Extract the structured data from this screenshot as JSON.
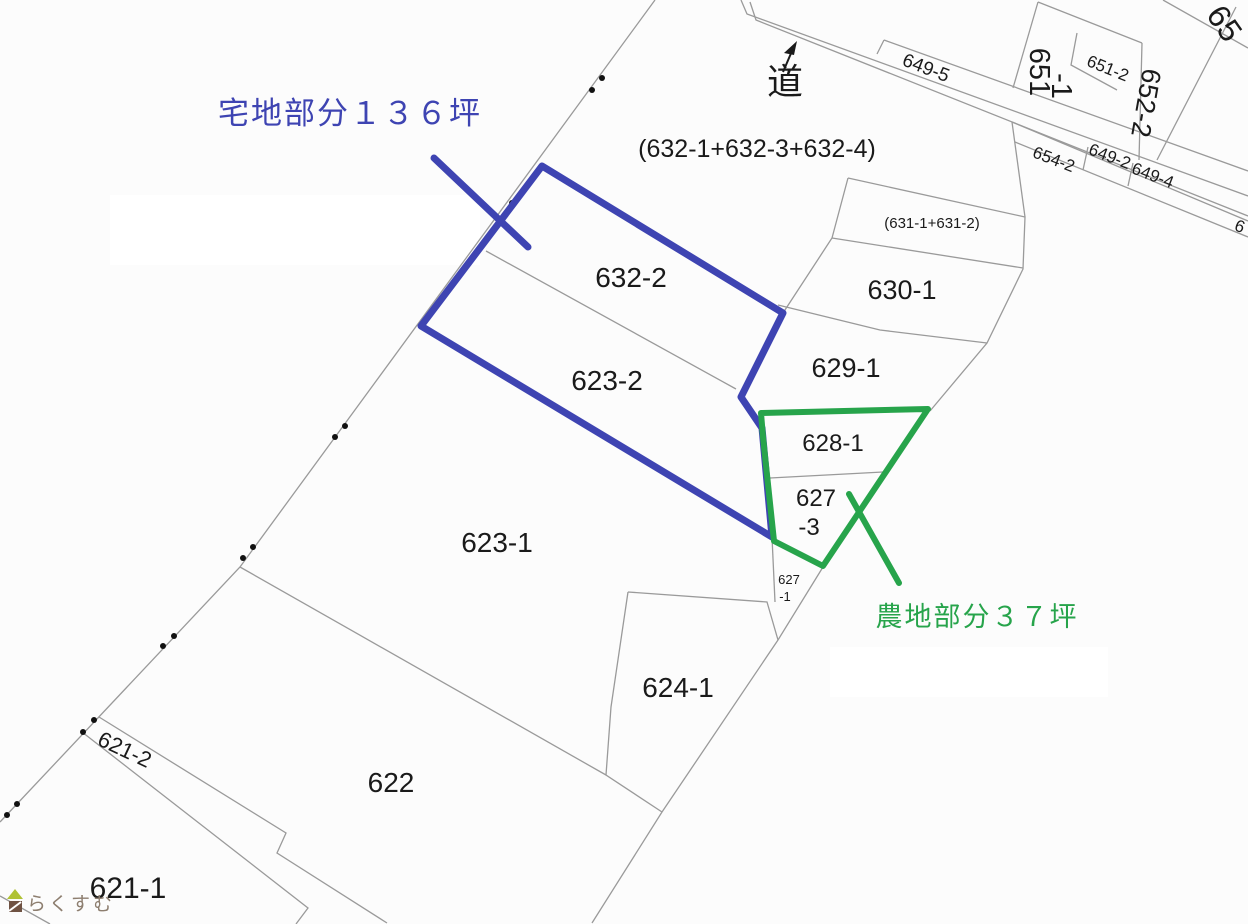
{
  "title": "cadastral-parcel-map",
  "colors": {
    "background": "#fcfcfc",
    "blue": "#3e44b2",
    "green": "#27a44b",
    "boundary_line": "#9a9a9a",
    "text": "#1a1a1a",
    "watermark_text": "#8d7e6f",
    "logo_roof": "#b0c235",
    "logo_body": "#6f5243"
  },
  "annotations": {
    "residential_area_tsubo": "136",
    "farmland_area_tsubo": "37"
  },
  "labels": [
    {
      "id": "annotation-residential",
      "text": "宅地部分１３６坪"
    },
    {
      "id": "road",
      "text": "道"
    },
    {
      "id": "parcel-632-1-632-3-632-4",
      "text": "(632-1+632-3+632-4)"
    },
    {
      "id": "parcel-649-5",
      "text": "649-5"
    },
    {
      "id": "parcel-651-1-line1",
      "text": "651"
    },
    {
      "id": "parcel-651-1-line2",
      "text": "-1"
    },
    {
      "id": "parcel-651-2",
      "text": "651-2"
    },
    {
      "id": "parcel-652-2",
      "text": "652-2"
    },
    {
      "id": "parcel-654-2",
      "text": "654-2"
    },
    {
      "id": "parcel-649-2",
      "text": "649-2"
    },
    {
      "id": "parcel-649-4",
      "text": "649-4"
    },
    {
      "id": "parcel-65x-partial",
      "text": "65"
    },
    {
      "id": "parcel-6xx-partial",
      "text": "6"
    },
    {
      "id": "parcel-631-1-631-2",
      "text": "(631-1+631-2)"
    },
    {
      "id": "parcel-630-1",
      "text": "630-1"
    },
    {
      "id": "parcel-629-1",
      "text": "629-1"
    },
    {
      "id": "parcel-632-2",
      "text": "632-2"
    },
    {
      "id": "parcel-623-2",
      "text": "623-2"
    },
    {
      "id": "parcel-628-1",
      "text": "628-1"
    },
    {
      "id": "parcel-627-3-line1",
      "text": "627"
    },
    {
      "id": "parcel-627-3-line2",
      "text": "-3"
    },
    {
      "id": "parcel-627-1-line1",
      "text": "627"
    },
    {
      "id": "parcel-627-1-line2",
      "text": "-1"
    },
    {
      "id": "annotation-farmland",
      "text": "農地部分３７坪"
    },
    {
      "id": "parcel-623-1",
      "text": "623-1"
    },
    {
      "id": "parcel-624-1",
      "text": "624-1"
    },
    {
      "id": "parcel-622",
      "text": "622"
    },
    {
      "id": "parcel-621-2",
      "text": "621-2"
    },
    {
      "id": "parcel-621-1",
      "text": "621-1"
    },
    {
      "id": "watermark",
      "text": "らくすむ"
    }
  ]
}
